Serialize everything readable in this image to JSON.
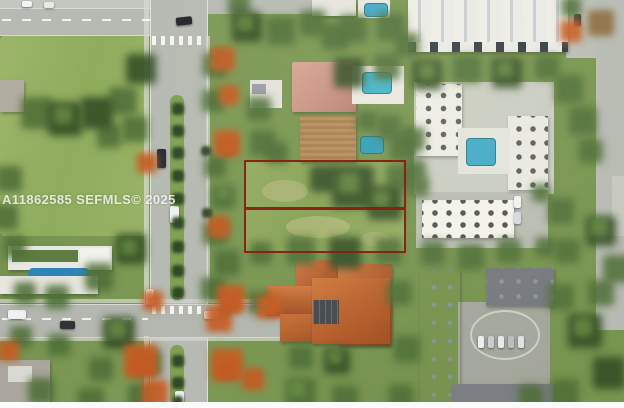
{
  "photo": {
    "kind": "aerial-drone-photo",
    "scene": "Residential neighborhood aerial view with a vacant double parcel outlined in red, divided road with palm median on the left, white apartment buildings with pools on the right, terracotta-roof homes at center bottom",
    "watermark": {
      "text": "A11862585 SEFMLS© 2025"
    },
    "annotation": {
      "name": "subject-lot-outline",
      "parcels": 2,
      "outline_color": "#8a1f10"
    },
    "palette": {
      "grass_base": "#76924e",
      "park_grass": "#99b366",
      "road_gray": "#b6bab2",
      "sidewalk": "#d6d8d0",
      "tree_dark": "#365027",
      "tree_mid": "#4f6e38",
      "tree_orange": "#c55c24",
      "pool_teal": "#3fa9c6",
      "roof_terracotta": "#b5622f",
      "roof_salmon": "#cc9687",
      "building_white": "#edece6",
      "building_gray": "#72767b",
      "lot_outline": "#8a1f10",
      "wm_color": "rgba(255,255,255,0.8)",
      "bottom_bar": "#fbfbfb"
    }
  }
}
